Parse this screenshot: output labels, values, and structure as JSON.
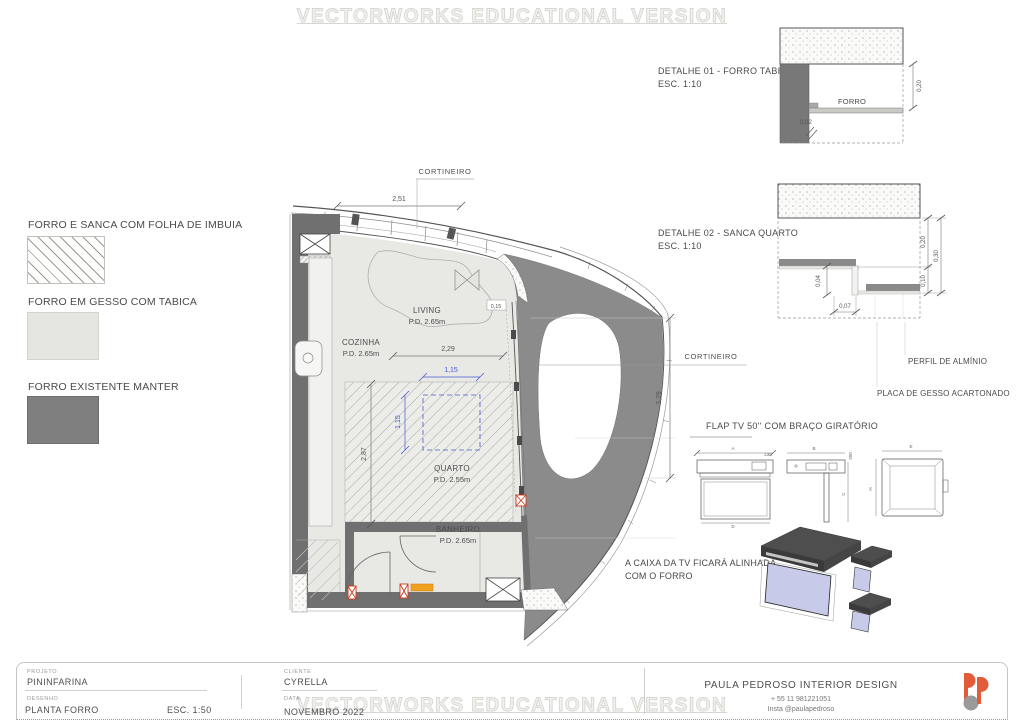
{
  "watermark": {
    "top": "VECTORWORKS EDUCATIONAL VERSION",
    "bottom": "VECTORWORKS EDUCATIONAL VERSION"
  },
  "legend": {
    "items": [
      {
        "label": "FORRO E SANCA COM FOLHA DE IMBUIA",
        "swatch": "diagonal-hatch"
      },
      {
        "label": "FORRO EM GESSO COM TABICA",
        "swatch": "light-gray"
      },
      {
        "label": "FORRO EXISTENTE MANTER",
        "swatch": "dark-gray"
      }
    ]
  },
  "plan": {
    "cortineiro_top": "CORTINEIRO",
    "cortineiro_right": "CORTINEIRO",
    "rooms": [
      {
        "name": "LIVING",
        "pd": "P.D. 2.65m"
      },
      {
        "name": "COZINHA",
        "pd": "P.D. 2.65m"
      },
      {
        "name": "QUARTO",
        "pd": "P.D. 2.55m"
      },
      {
        "name": "BANHEIRO",
        "pd": "P.D. 2.65m"
      }
    ],
    "dims": {
      "top_width": "2,51",
      "living_width": "2,29",
      "tv_w": "1,15",
      "tv_h": "1,15",
      "left_height": "2,87",
      "right_height": "3,29",
      "corner": "0,15"
    }
  },
  "details": {
    "d01": {
      "title": "DETALHE 01 - FORRO TABICADO",
      "scale": "ESC. 1:10",
      "forro": "FORRO",
      "dim_a": "0,20",
      "dim_b": "0,02"
    },
    "d02": {
      "title": "DETALHE 02 - SANCA QUARTO",
      "scale": "ESC. 1:10",
      "dim_020": "0,20",
      "dim_030": "0,30",
      "dim_010": "0,10",
      "dim_004": "0,04",
      "dim_007": "0,07",
      "label_perfil": "PERFIL DE ALMÍNIO",
      "label_placa": "PLACA DE GESSO ACARTONADO"
    }
  },
  "tv": {
    "title": "FLAP TV  50'' COM BRAÇO GIRATÓRIO",
    "dim_a": "A",
    "dim_b": "B",
    "dim_c": "C",
    "dim_d": "D",
    "dim_e": "E",
    "dim_h": "H",
    "dim_230": "230",
    "dim_200": "200",
    "note1": "A CAIXA DA TV FICARÁ ALINHADA",
    "note2": "COM O FORRO"
  },
  "title_block": {
    "projeto_label": "PROJETO",
    "projeto": "PININFARINA",
    "desenho_label": "DESENHO",
    "desenho": "PLANTA  FORRO",
    "escala": "ESC. 1:50",
    "cliente_label": "CLIENTE",
    "cliente": "CYRELLA",
    "data_label": "DATA",
    "data": "NOVEMBRO 2022",
    "studio": "PAULA PEDROSO INTERIOR DESIGN",
    "phone": "+ 55 11 981221051",
    "insta": "Insta @paulapedroso"
  },
  "colors": {
    "existing_ceiling": "#8b8b8b",
    "wall_poche": "#707070",
    "gesso_ceiling": "#e8e8e5",
    "dim_blue": "#4a5bd4",
    "marker_red": "#cc3a1a",
    "marker_orange": "#f0a01e",
    "tv_screen": "#c7cbe9",
    "logo_orange": "#e25c39",
    "logo_gray": "#9a9a9a",
    "watermark": "#d6d6d2"
  }
}
